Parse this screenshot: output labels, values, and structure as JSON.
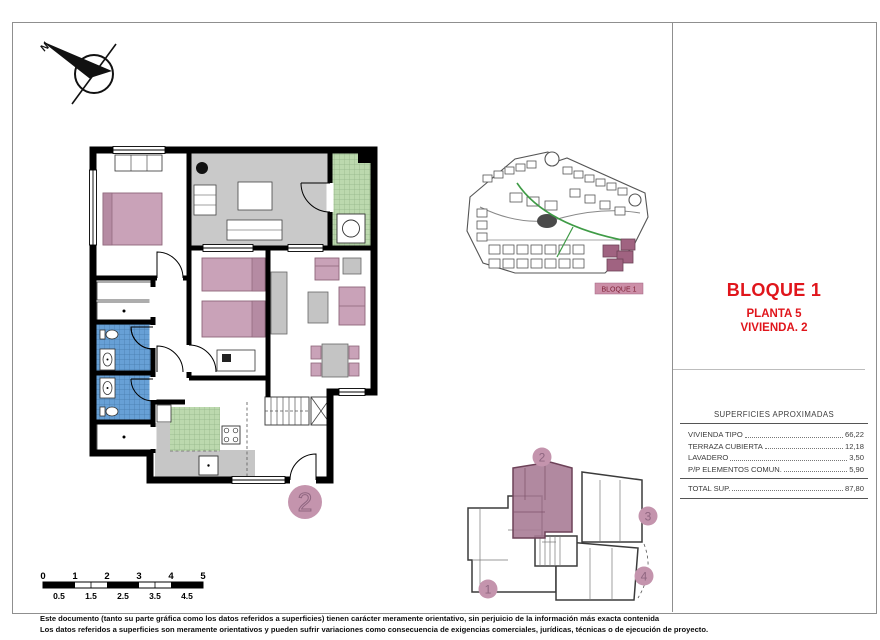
{
  "title_block": {
    "block": "BLOQUE 1",
    "floor": "PLANTA 5",
    "unit": "VIVIENDA. 2",
    "accent_color": "#e0151b"
  },
  "compass": {
    "north_label": "N"
  },
  "site_plan": {
    "block_label": "BLOQUE 1",
    "highlight_color": "#a06381"
  },
  "floor_plan": {
    "unit_number": "2",
    "colors": {
      "furniture_pink": "#c9a2b8",
      "terrace_gray": "#c9c9c9",
      "tiles_green": "#bcd9ae",
      "tiles_blue": "#67a0d6",
      "badge_mauve": "#c494ad"
    }
  },
  "key_plan": {
    "unit_labels": [
      "1",
      "2",
      "3",
      "4"
    ],
    "highlighted_unit": "2"
  },
  "surfaces_table": {
    "title": "SUPERFICIES APROXIMADAS",
    "rows": [
      {
        "label": "VIVIENDA TIPO",
        "value": "66,22"
      },
      {
        "label": "TERRAZA CUBIERTA",
        "value": "12,18"
      },
      {
        "label": "LAVADERO",
        "value": "3,50"
      },
      {
        "label": "P/P ELEMENTOS COMUN.",
        "value": "5,90"
      }
    ],
    "total": {
      "label": "TOTAL SUP.",
      "value": "87,80"
    }
  },
  "scale_bar": {
    "top_labels": [
      "0",
      "1",
      "2",
      "3",
      "4",
      "5"
    ],
    "bottom_labels": [
      "0.5",
      "1.5",
      "2.5",
      "3.5",
      "4.5"
    ]
  },
  "disclaimer": {
    "line1": "Este documento (tanto su parte gráfica como los datos referidos a superficies) tienen carácter meramente orientativo, sin perjuicio de la información más exacta contenida",
    "line2": "Los datos referidos a superficies son meramente orientativos y pueden sufrir variaciones como consecuencia de exigencias comerciales, jurídicas, técnicas o de ejecución de proyecto."
  }
}
